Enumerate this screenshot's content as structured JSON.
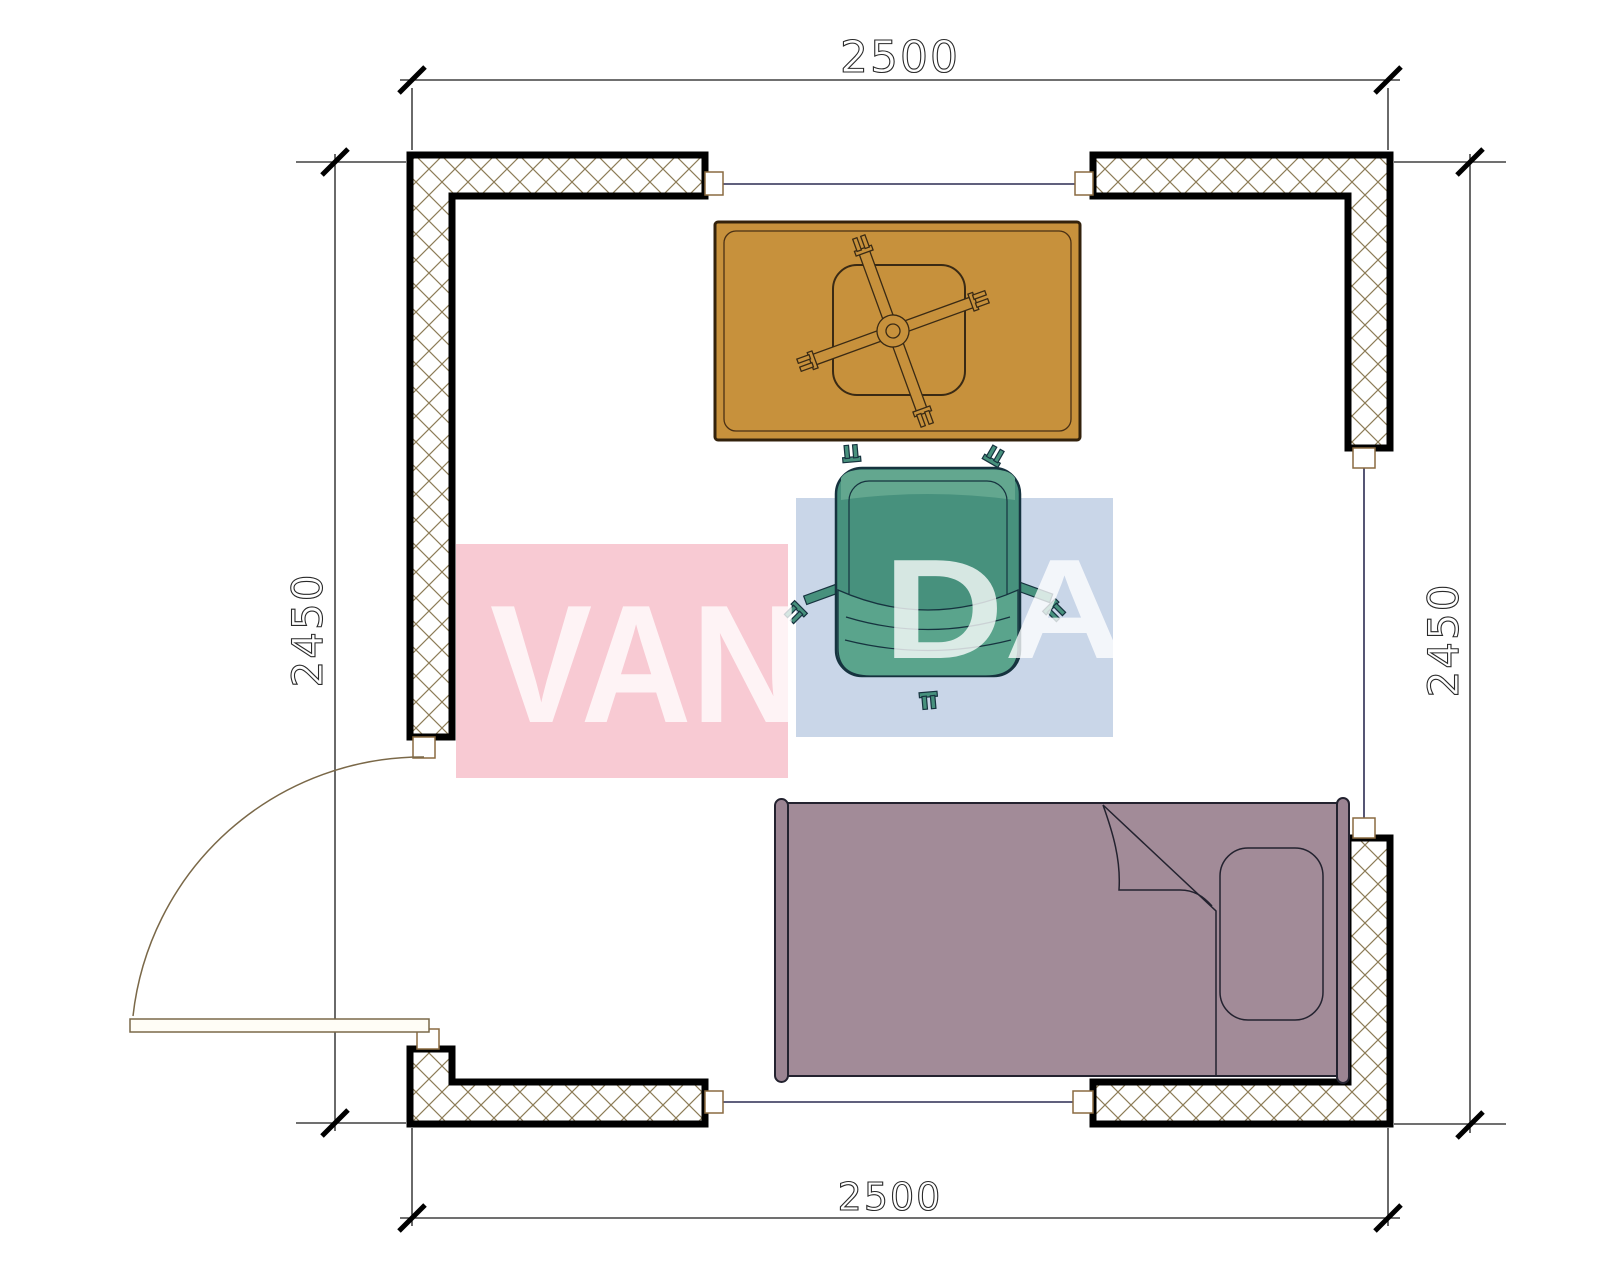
{
  "page": {
    "background": "#ffffff",
    "kind": "architectural floor plan drawing"
  },
  "dimensions": {
    "top": "2500",
    "bottom": "2500",
    "left": "2450",
    "right": "2450"
  },
  "watermark": {
    "full_text": "VANDA",
    "left_fragment": "VAN",
    "right_fragment": "DA",
    "pink_block_color": "#f8cad3",
    "blue_block_color": "#c9d6e8",
    "text_color": "rgba(255,255,255,0.78)"
  },
  "room": {
    "openings": [
      {
        "name": "window-top"
      },
      {
        "name": "window-right"
      },
      {
        "name": "window-bottom"
      },
      {
        "name": "door-left",
        "swing": "quarter-circle arc"
      }
    ]
  },
  "furniture": [
    {
      "name": "desk",
      "color": "#c7913c"
    },
    {
      "name": "desk-chair-star-base",
      "color": "#c7913c"
    },
    {
      "name": "office-chair",
      "color": "#47917d"
    },
    {
      "name": "single-bed",
      "color": "#a28b98"
    }
  ],
  "colors": {
    "wall_outline": "#000000",
    "wall_hatch": "#8d7c57",
    "dimension_lines": "#1a1a1a",
    "dimension_text": "#2a2a2a",
    "window_line": "#2b2b52",
    "door_arc": "#7a6848",
    "desk_fill": "#c7913c",
    "desk_outline": "#33220c",
    "chair_fill": "#47917d",
    "chair_light": "#63a78f",
    "chair_band": "#5aa48c",
    "chair_outline": "#16333f",
    "bed_fill": "#a28b98",
    "bed_outline": "#23222f"
  }
}
